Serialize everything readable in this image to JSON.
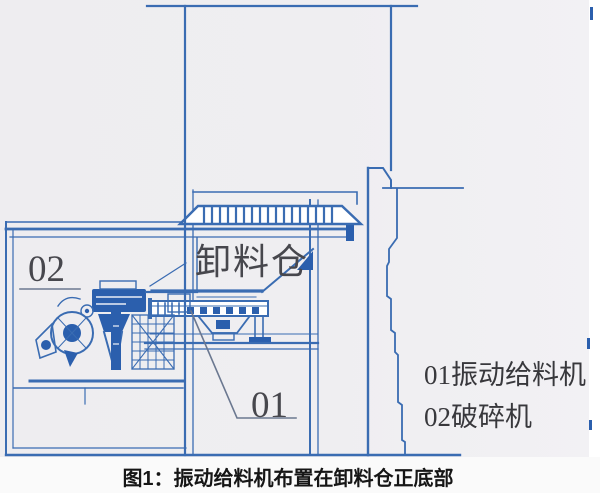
{
  "figure": {
    "bin_label": "卸料仓",
    "callout_01": "01",
    "callout_02": "02",
    "legend_line_1": "01振动给料机",
    "legend_line_2": "02破碎机",
    "caption": "图1：振动给料机布置在卸料仓正底部"
  },
  "colors": {
    "line_blue": "#3a6cb2",
    "fill_blue": "#2b5fad",
    "paper": "#efeef1",
    "caption_bg": "#fafafa",
    "label_gray": "#47474d",
    "legend_gray": "#38383c",
    "caption_black": "#161616",
    "leader_gray": "#6b7890"
  }
}
